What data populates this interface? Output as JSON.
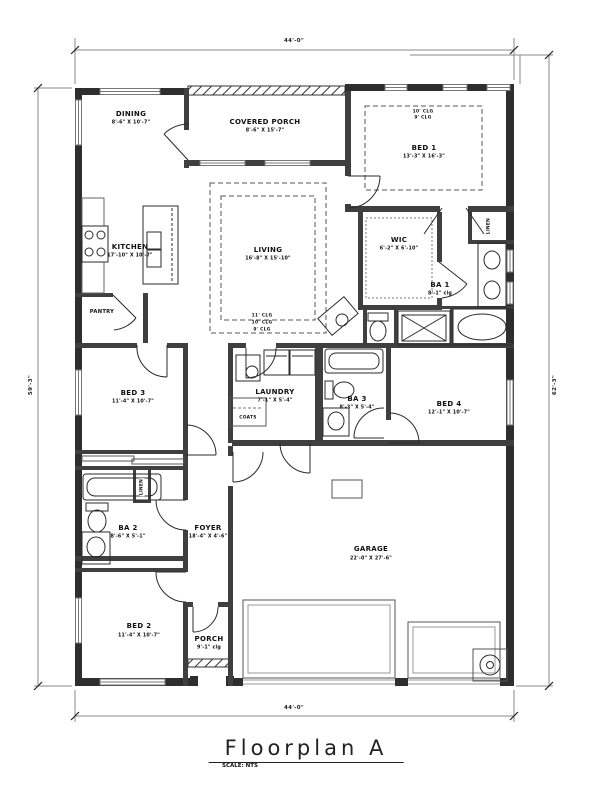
{
  "drawing": {
    "title": "Floorplan A",
    "scale_note": "SCALE: NTS"
  },
  "dimensions": {
    "top": "44'-0\"",
    "bottom": "44'-0\"",
    "left": "59'-3\"",
    "right": "62'-3\""
  },
  "rooms": {
    "dining": {
      "name": "DINING",
      "dims": "8'-6\" X 10'-7\""
    },
    "covered_porch": {
      "name": "COVERED PORCH",
      "dims": "8'-6\" X 15'-7\""
    },
    "bed1": {
      "name": "BED 1",
      "dims": "13'-3\" X 16'-3\""
    },
    "kitchen": {
      "name": "KITCHEN",
      "dims": "17'-10\" X 10'-7\""
    },
    "living": {
      "name": "LIVING",
      "dims": "16'-8\" X 15'-10\""
    },
    "wic": {
      "name": "WIC",
      "dims": "6'-2\" X 6'-10\""
    },
    "ba1": {
      "name": "BA 1",
      "dims": "8'-1\" clg"
    },
    "pantry": {
      "name": "PANTRY"
    },
    "bed3": {
      "name": "BED 3",
      "dims": "11'-4\" X 10'-7\""
    },
    "laundry": {
      "name": "LAUNDRY",
      "dims": "7'-1\" X 5'-4\""
    },
    "coats": {
      "name": "COATS"
    },
    "ba3": {
      "name": "BA 3",
      "dims": "8'-3\" X 5'-4\""
    },
    "bed4": {
      "name": "BED 4",
      "dims": "12'-1\" X 10'-7\""
    },
    "ba2": {
      "name": "BA 2",
      "dims": "8'-6\" X 5'-1\""
    },
    "linen1": {
      "name": "LINEN"
    },
    "linen2": {
      "name": "LINEN"
    },
    "foyer": {
      "name": "FOYER",
      "dims": "18'-4\" X 4'-6\""
    },
    "bed2": {
      "name": "BED 2",
      "dims": "11'-4\" X 10'-7\""
    },
    "porch": {
      "name": "PORCH",
      "dims": "9'-1\" clg"
    },
    "garage": {
      "name": "GARAGE",
      "dims": "22'-0\" X 27'-6\""
    }
  },
  "ceiling_notes": {
    "bed1": [
      "10' CLG",
      "9' CLG"
    ],
    "living": [
      "11' CLG",
      "10' CLG",
      "9' CLG"
    ]
  }
}
